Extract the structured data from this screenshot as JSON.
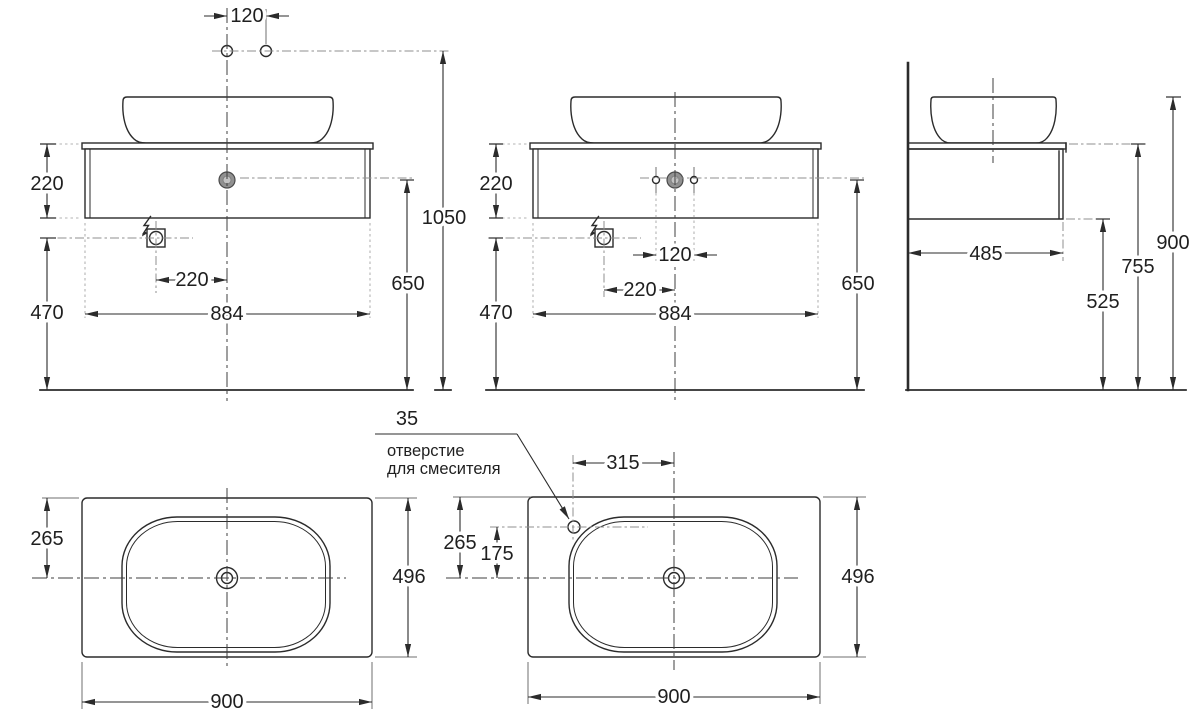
{
  "colors": {
    "ink": "#2b2b2b",
    "background": "#ffffff",
    "drain_fill": "#919191"
  },
  "views": {
    "frontA": {
      "dims": {
        "spacing": "120",
        "cabinetHeight": "220",
        "outletHeight": "470",
        "outletOffset": "220",
        "width": "884",
        "drainHeight": "650",
        "totalHeight": "1050"
      }
    },
    "frontB": {
      "dims": {
        "cabinetHeight": "220",
        "outletHeight": "470",
        "spacing": "120",
        "outletOffset": "220",
        "width": "884",
        "drainHeight": "650"
      }
    },
    "side": {
      "dims": {
        "depth": "485",
        "bottomHeight": "525",
        "worktopHeight": "755",
        "totalHeight": "900"
      }
    },
    "planA": {
      "dims": {
        "centerOffset": "265",
        "depth": "496",
        "width": "900"
      }
    },
    "planB": {
      "dims": {
        "holeOffset": "315",
        "centerOffset": "265",
        "holeToCenter": "175",
        "depth": "496",
        "width": "900"
      },
      "note": {
        "diameter": "35",
        "line1": "отверстие",
        "line2": "для смесителя"
      }
    }
  }
}
